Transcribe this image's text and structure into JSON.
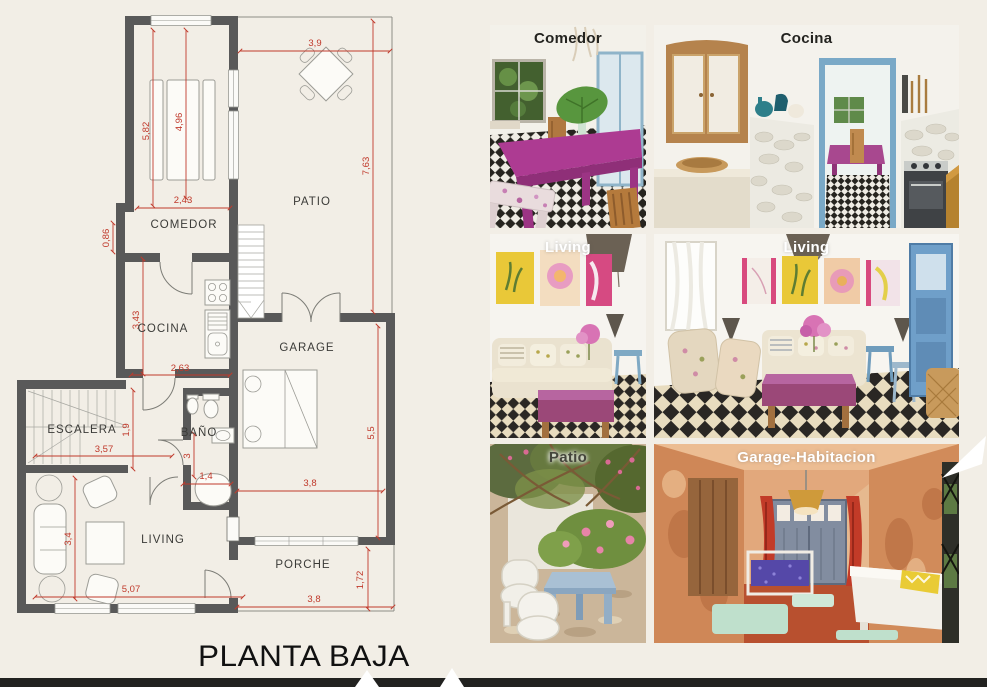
{
  "plan": {
    "title": "PLANTA BAJA",
    "wall_color": "#595959",
    "dim_color": "#c0392b",
    "rooms": {
      "comedor": "COMEDOR",
      "patio": "PATIO",
      "cocina": "COCINA",
      "garage": "GARAGE",
      "escalera": "ESCALERA",
      "bano": "BAÑO",
      "living": "LIVING",
      "porche": "PORCHE"
    },
    "dims": {
      "patio_width": "3,9",
      "patio_height": "7,63",
      "comedor_h1": "5,82",
      "comedor_h2": "4,96",
      "comedor_w": "2,43",
      "step": "0,86",
      "cocina_h": "3,43",
      "cocina_w": "2,63",
      "hall_h": "1,9",
      "escalera_w": "3,57",
      "bano_h": "3",
      "bano_w": "1,4",
      "garage_w": "3,8",
      "garage_h": "5,5",
      "living_h": "3,4",
      "living_w": "5,07",
      "porche_h": "1,72",
      "porche_w": "3,8"
    }
  },
  "photos": [
    {
      "id": "comedor",
      "label": "Comedor"
    },
    {
      "id": "cocina",
      "label": "Cocina"
    },
    {
      "id": "living-small",
      "label": "Living"
    },
    {
      "id": "living-large",
      "label": "Living"
    },
    {
      "id": "patio",
      "label": "Patio"
    },
    {
      "id": "garage-habitacion",
      "label": "Garage-Habitacion"
    }
  ]
}
